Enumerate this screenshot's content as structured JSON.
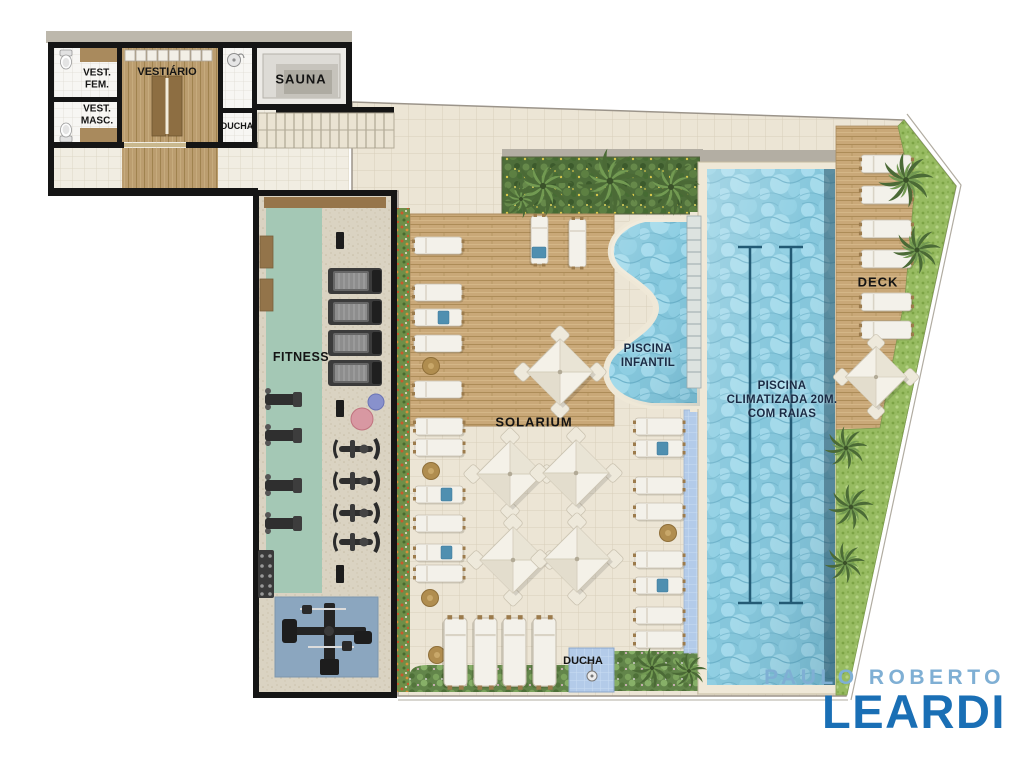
{
  "labels": {
    "vest_fem": [
      "VEST.",
      "FEM."
    ],
    "vest_masc": [
      "VEST.",
      "MASC."
    ],
    "vestiario": "VESTIÁRIO",
    "ducha_top": "DUCHA",
    "sauna": "SAUNA",
    "fitness": "FITNESS",
    "solarium": "SOLARIUM",
    "piscina_infantil": [
      "PISCINA",
      "INFANTIL"
    ],
    "piscina_climatizada": [
      "PISCINA",
      "CLIMATIZADA 20M.",
      "COM RAIAS"
    ],
    "deck": "DECK",
    "ducha_bottom": "DUCHA"
  },
  "branding": {
    "top": "PAULO ROBERTO",
    "name": "LEARDI"
  },
  "colors": {
    "label": "#141414",
    "pool_label": "#1a2b45",
    "logo_light": "#7fafd4",
    "logo_dark": "#1a6fb5",
    "wall": "#151515",
    "tile": "#ece5d5",
    "wood": "#c9a878",
    "water": "#7fc4da",
    "grass": "#97bb61",
    "fitness_mat": "#a4c8b5",
    "gym_mat": "#8ba6bf",
    "ducha_tile": "#b3cbe9"
  }
}
